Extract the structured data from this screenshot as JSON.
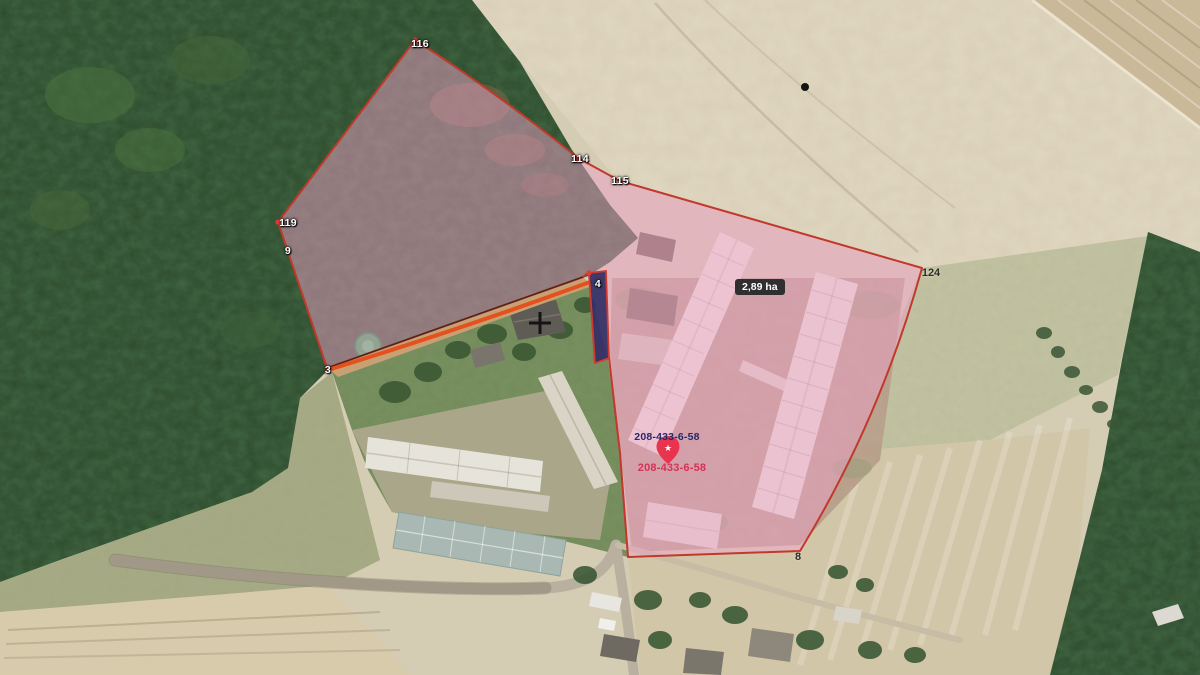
{
  "map": {
    "area_badge": "2,89 ha",
    "parcel_id_top": "208-433-6-58",
    "parcel_id_bottom": "208-433-6-58",
    "point_labels": {
      "v116": "116",
      "v114": "114",
      "v115": "115",
      "v119": "119",
      "v9": "9",
      "v3": "3",
      "v4": "4",
      "v124": "124",
      "v8": "8"
    },
    "icons": {
      "pin_star": "★"
    },
    "colors": {
      "selection_fill": "#eda0c6",
      "selection_border": "#c0392b",
      "edge_dark": "#30241a",
      "highlight_line": "#e4511d",
      "strip_fill": "#23255e",
      "strip_border": "#cf3a2e",
      "vertex_dot": "#e03c30",
      "pin": "#e8344e",
      "badge_bg": "#2f2f2f",
      "badge_text": "#ffffff",
      "parcel_label_top": "#26286b",
      "parcel_label_bottom": "#d23357",
      "crosshair": "#141414"
    }
  }
}
